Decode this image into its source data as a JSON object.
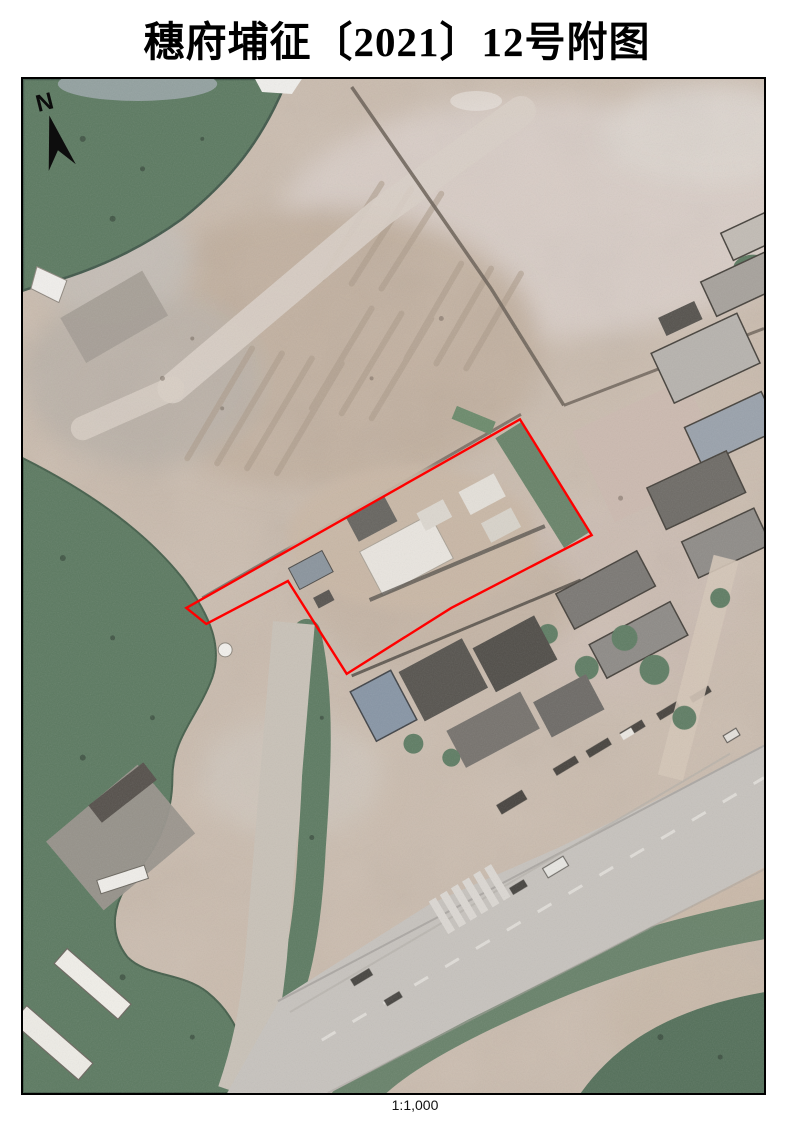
{
  "page": {
    "title": "穗府埔征〔2021〕12号附图"
  },
  "map": {
    "north_label": "N",
    "scale_label": "1:1,000",
    "parcel_outline_points": "499,341 571,457 430,530 325,596 266,503 184,546 164,530",
    "parcel_outline_color": "#ff0000",
    "border_color": "#000000",
    "palette": {
      "dirt": "#cbbcae",
      "vegetation": "#5c7a61",
      "road": "#c7c3be",
      "pond_water": "#93a1a0",
      "roof_white": "#e9e5df",
      "roof_slate": "#8795a5"
    }
  }
}
